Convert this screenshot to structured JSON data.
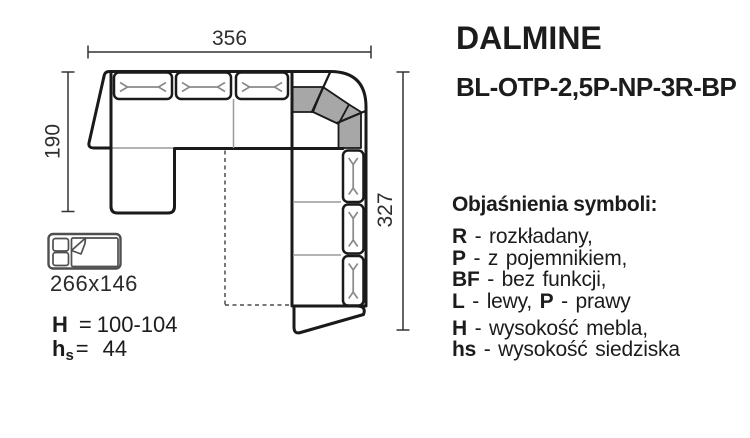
{
  "header": {
    "title": "DALMINE",
    "model_code": "BL-OTP-2,5P-NP-3R-BP"
  },
  "dimensions": {
    "width": "356",
    "left_depth": "190",
    "right_depth": "327"
  },
  "sleeping": {
    "bed_size": "266x146"
  },
  "specs": {
    "height": {
      "label": "H",
      "eq": "=",
      "value": "100-104"
    },
    "seat_height": {
      "label": "h",
      "sub": "s",
      "eq": "=",
      "value": "44"
    }
  },
  "legend": {
    "heading": "Objaśnienia symboli:",
    "items": [
      {
        "bold": "R",
        "rest": " - rozkładany,"
      },
      {
        "bold": "P",
        "rest": " - z pojemnikiem,"
      },
      {
        "bold": "BF",
        "rest": " - bez funkcji,"
      },
      {
        "bold": "L",
        "rest": " - lewy, ",
        "bold2": "P",
        "rest2": " - prawy"
      },
      {
        "bold": "H",
        "rest": " - wysokość mebla,"
      },
      {
        "bold": "hs",
        "rest": " - wysokość siedziska"
      }
    ]
  },
  "colors": {
    "corner_backrest": "#a7a7a7",
    "outline": "#1a1a1a"
  }
}
